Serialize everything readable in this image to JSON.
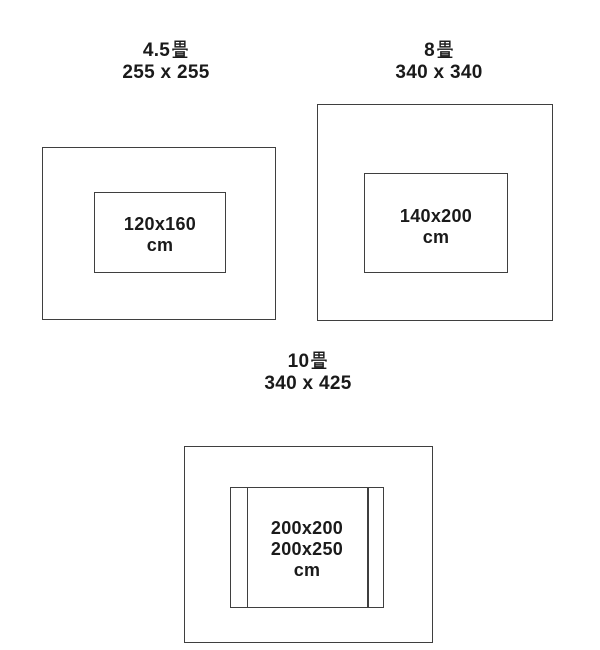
{
  "colors": {
    "background": "#ffffff",
    "line": "#3f3f3f",
    "text": "#1a1a1a"
  },
  "diagrams": [
    {
      "title_full": "4.5畳",
      "title_number": "4.5",
      "title_unit": "畳",
      "room_size": "255 x 255",
      "rug_lines": [
        "120x160",
        "cm"
      ]
    },
    {
      "title_full": "8畳",
      "title_number": "8",
      "title_unit": "畳",
      "room_size": "340 x 340",
      "rug_lines": [
        "140x200",
        "cm"
      ]
    },
    {
      "title_full": "10畳",
      "title_number": "10",
      "title_unit": "畳",
      "room_size": "340 x 425",
      "rug_lines": [
        "200x200",
        "200x250",
        "cm"
      ]
    }
  ]
}
